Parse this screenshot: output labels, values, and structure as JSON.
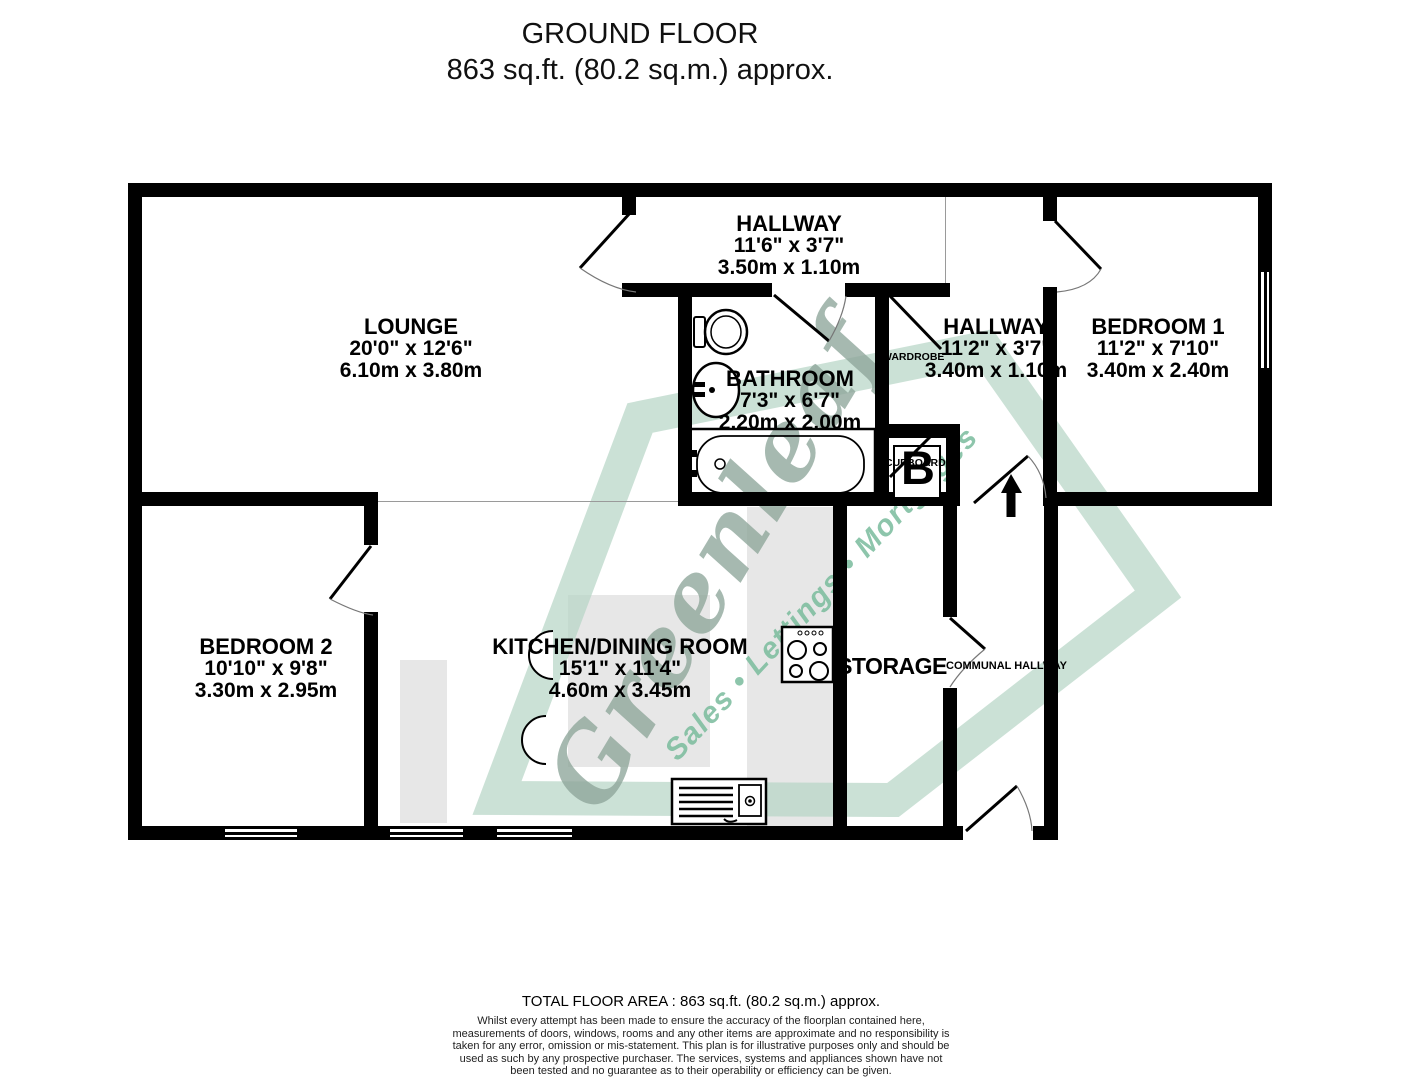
{
  "title": {
    "line1": "GROUND FLOOR",
    "line2": "863 sq.ft. (80.2 sq.m.) approx."
  },
  "rooms": {
    "hallway1": {
      "name": "HALLWAY",
      "imperial": "11'6\"  x 3'7\"",
      "metric": "3.50m  x 1.10m"
    },
    "lounge": {
      "name": "LOUNGE",
      "imperial": "20'0\"  x 12'6\"",
      "metric": "6.10m  x 3.80m"
    },
    "bathroom": {
      "name": "BATHROOM",
      "imperial": "7'3\"  x 6'7\"",
      "metric": "2.20m  x 2.00m"
    },
    "hallway2": {
      "name": "HALLWAY",
      "imperial": "11'2\"  x 3'7\"",
      "metric": "3.40m  x 1.10m"
    },
    "bedroom1": {
      "name": "BEDROOM 1",
      "imperial": "11'2\"  x 7'10\"",
      "metric": "3.40m  x 2.40m"
    },
    "bedroom2": {
      "name": "BEDROOM 2",
      "imperial": "10'10\"  x 9'8\"",
      "metric": "3.30m  x 2.95m"
    },
    "kitchen": {
      "name": "KITCHEN/DINING ROOM",
      "imperial": "15'1\"  x 11'4\"",
      "metric": "4.60m  x 3.45m"
    },
    "storage": {
      "name": "STORAGE"
    },
    "communal": {
      "name": "COMMUNAL HALLWAY"
    },
    "wardrobe": {
      "name": "WARDROBE"
    },
    "cupboard": {
      "name": "CUPBOARD",
      "boiler": "B"
    }
  },
  "watermark": {
    "brand": "Greenleaf",
    "tagline": "Sales • Lettings • Mortgages",
    "leaf_color": "#b7d6c6",
    "brand_color": "#8ea69a",
    "tagline_color": "#7abc9d"
  },
  "footer": {
    "total": "TOTAL FLOOR AREA : 863 sq.ft. (80.2 sq.m.) approx.",
    "disclaimer": "Whilst every attempt has been made to ensure the accuracy of the floorplan contained here, measurements of doors, windows, rooms and any other items are approximate and no responsibility is taken for any error, omission or mis-statement. This plan is for illustrative purposes only and should be used as such by any prospective purchaser. The services, systems and appliances shown have not been tested and no guarantee as to their operability or efficiency can be given.",
    "made": "Made with Metropix ©2022"
  },
  "colors": {
    "wall": "#000000",
    "counter": "#e7e7e7"
  }
}
